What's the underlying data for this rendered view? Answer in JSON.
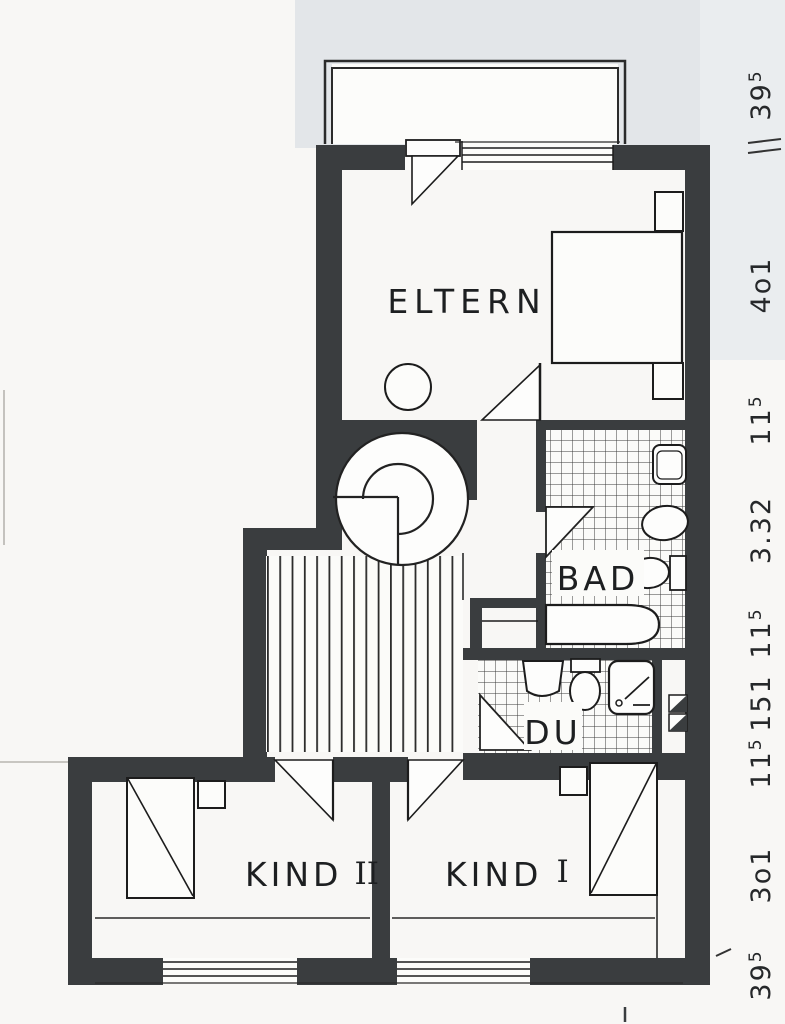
{
  "plan": {
    "rooms": {
      "parents": "ELTERN",
      "bath": "BAD",
      "shower": "DU",
      "child1_word": "KIND",
      "child1_numeral": "I",
      "child2_word": "KIND",
      "child2_numeral": "II"
    },
    "dimensions": [
      {
        "main": "39",
        "sup": "5"
      },
      {
        "main": "4o1",
        "sup": ""
      },
      {
        "main": "11",
        "sup": "5"
      },
      {
        "main": "3.32",
        "sup": ""
      },
      {
        "main": "11",
        "sup": "5"
      },
      {
        "main": "151",
        "sup": ""
      },
      {
        "main": "11",
        "sup": "5"
      },
      {
        "main": "3o1",
        "sup": ""
      },
      {
        "main": "39",
        "sup": "5"
      }
    ],
    "colors": {
      "wall": "#3a3d3f",
      "line": "#1c1c1c",
      "paper": "#f8f7f5",
      "scan_band": "#e3e6e9"
    }
  }
}
